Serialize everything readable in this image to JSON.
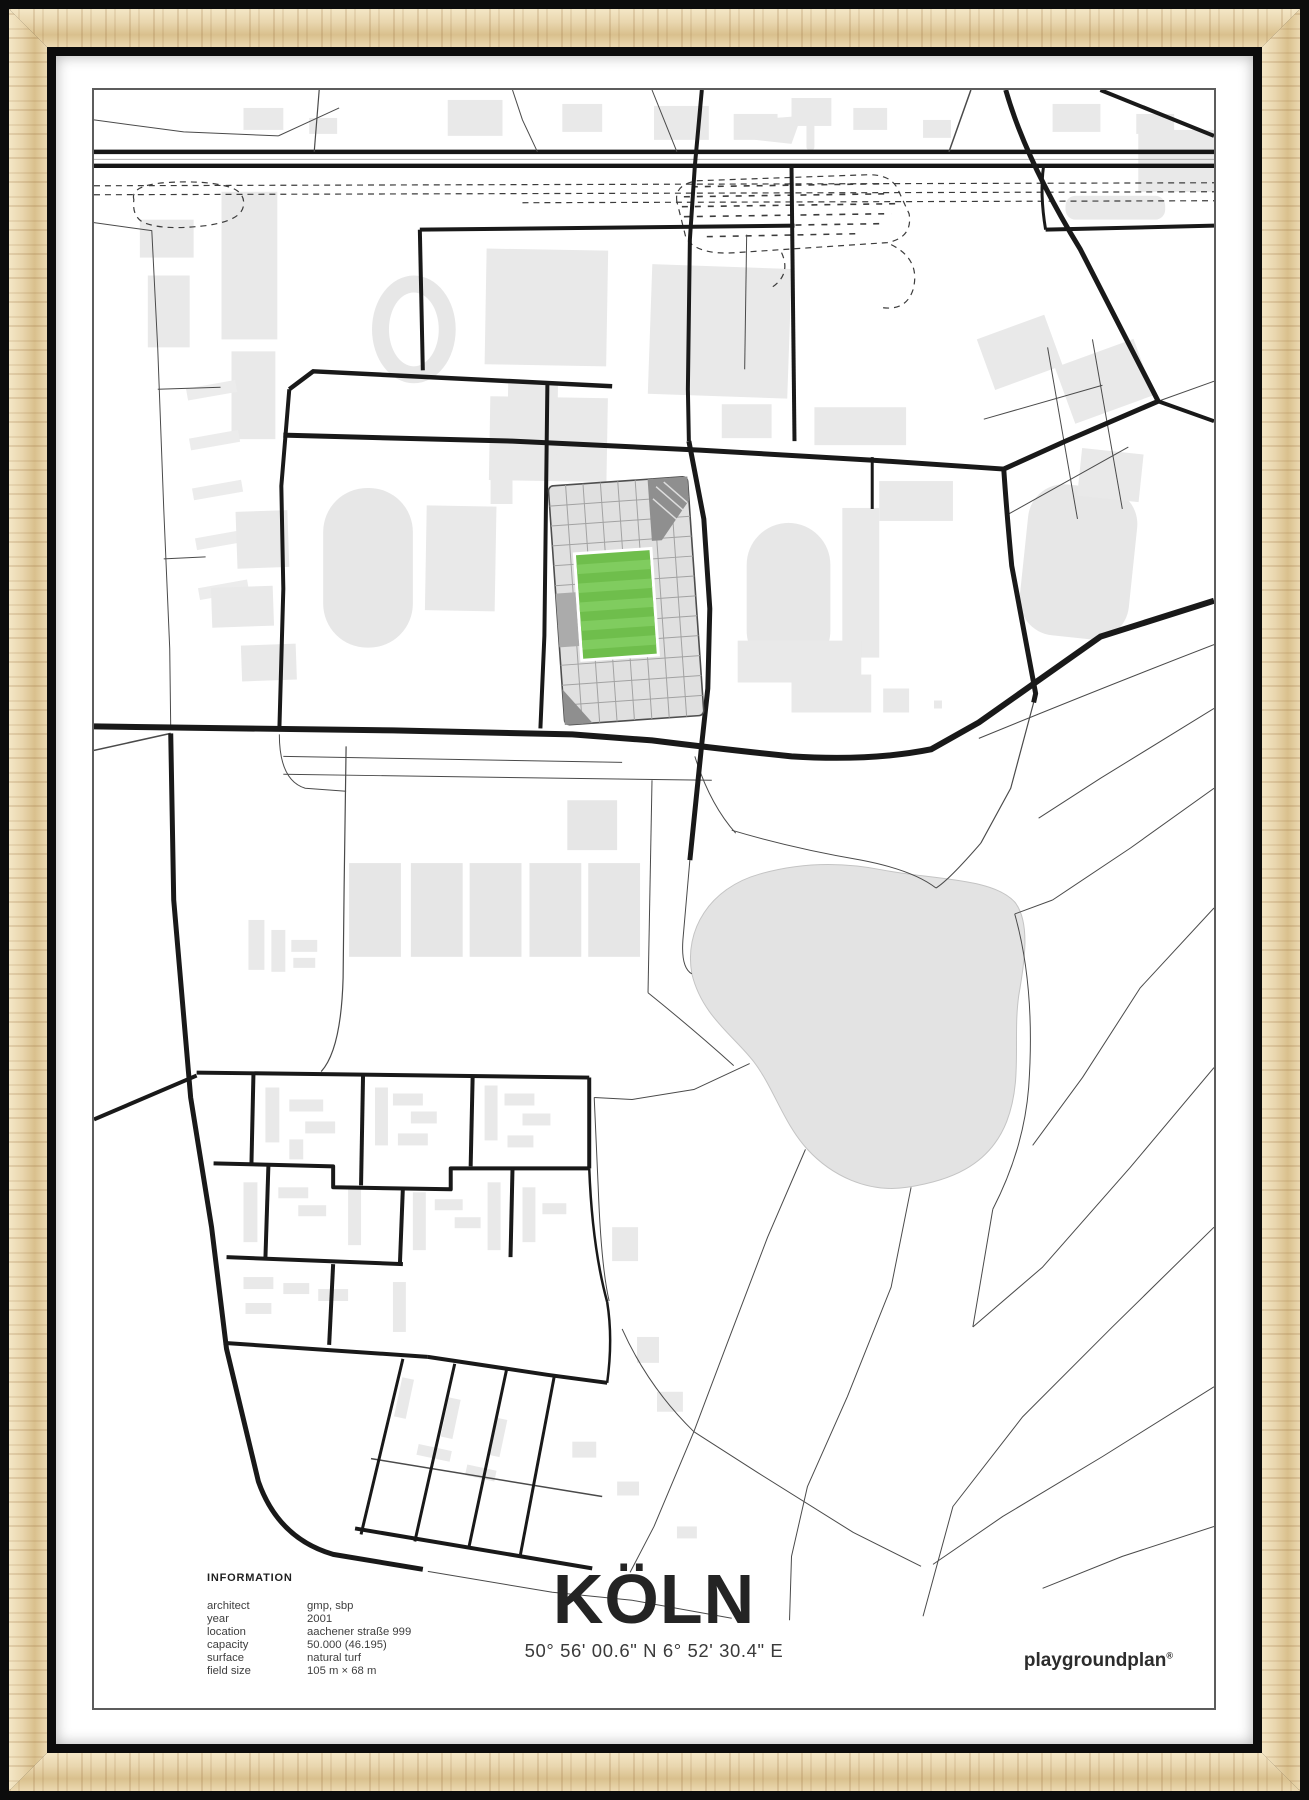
{
  "poster": {
    "title": "KÖLN",
    "coordinates": "50° 56' 00.6\" N  6° 52' 30.4\" E",
    "brand": "playgroundplan",
    "brand_mark": "®",
    "info": {
      "heading": "INFORMATION",
      "rows": [
        {
          "label": "architect",
          "value": "gmp, sbp"
        },
        {
          "label": "year",
          "value": "2001"
        },
        {
          "label": "location",
          "value": "aachener straße 999"
        },
        {
          "label": "capacity",
          "value": "50.000 (46.195)"
        },
        {
          "label": "surface",
          "value": "natural turf"
        },
        {
          "label": "field size",
          "value": "105 m × 68 m"
        }
      ]
    },
    "map_colors": {
      "pitch_green": "#6fbe4c",
      "pitch_green_light": "#80cc5f",
      "building_gray": "#e9e9e9",
      "road_black": "#191919",
      "water_gray": "#e3e3e3",
      "frame_wood": "#e9d6ae"
    }
  }
}
